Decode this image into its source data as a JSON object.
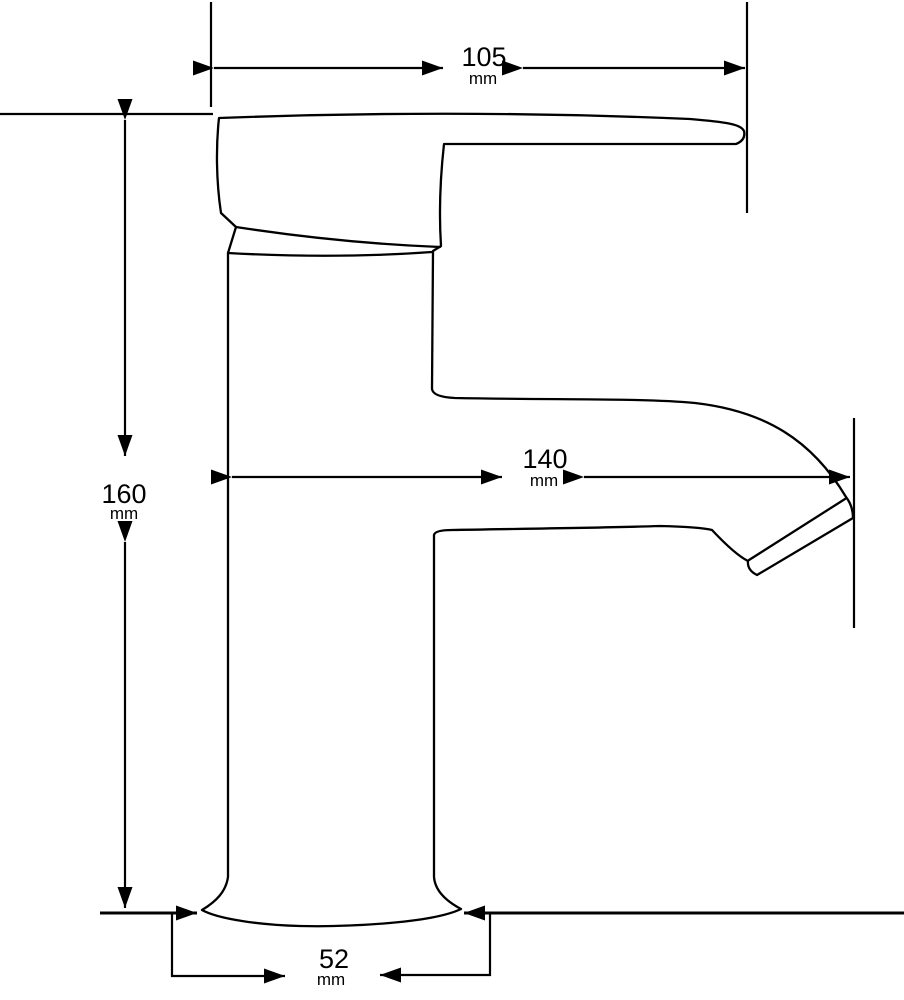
{
  "diagram": {
    "subject": "basin-tap-dimension-drawing",
    "colors": {
      "line": "#000000",
      "background": "#ffffff"
    },
    "dimensions": {
      "top_width": {
        "value": "105",
        "unit": "mm"
      },
      "left_height": {
        "value": "160",
        "unit": "mm"
      },
      "spout_reach": {
        "value": "140",
        "unit": "mm"
      },
      "base_width": {
        "value": "52",
        "unit": "mm"
      }
    }
  }
}
